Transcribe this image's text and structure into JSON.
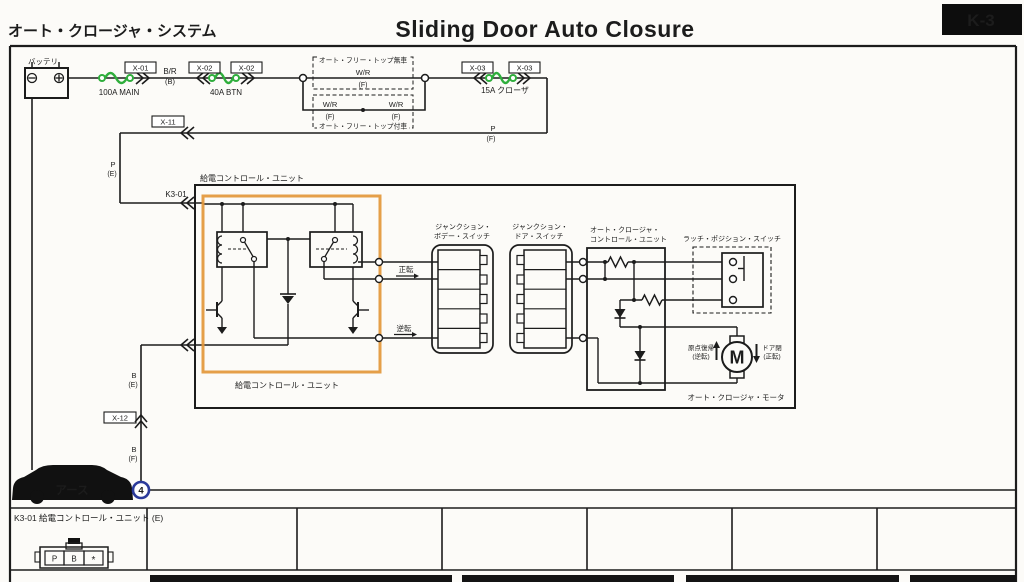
{
  "header": {
    "system_title": "オート・クロージャ・システム",
    "title": "Sliding Door Auto Closure",
    "page_code": "K-3"
  },
  "battery": {
    "label": "バッテリ"
  },
  "fuses": {
    "main": "100A MAIN",
    "btn": "40A BTN",
    "closer": "15A クローザ"
  },
  "connectors": {
    "x01": "X-01",
    "x02": "X-02",
    "x03": "X-03",
    "x11": "X-11",
    "x12": "X-12",
    "k301": "K3-01"
  },
  "wires": {
    "br": "B/R",
    "wr": "W/R",
    "p": "P",
    "b": "B",
    "loc_b": "(B)",
    "loc_e": "(E)",
    "loc_f": "(F)"
  },
  "options": {
    "without_top": "オート・フリー・トップ無車",
    "with_top": "オート・フリー・トップ付車"
  },
  "units": {
    "power": "給電コントロール・ユニット",
    "acu_line1": "オート・クロージャ・",
    "acu_line2": "コントロール・ユニット",
    "jb_body_line1": "ジャンクション・",
    "jb_body_line2": "ボデー・スイッチ",
    "jb_door_line1": "ジャンクション・",
    "jb_door_line2": "ドア・スイッチ",
    "latch": "ラッチ・ポジション・スイッチ",
    "motor": "オート・クロージャ・モータ"
  },
  "signals": {
    "forward": "正転",
    "reverse": "逆転"
  },
  "motor": {
    "m": "M",
    "left_line1": "原点復帰",
    "left_line2": "(逆転)",
    "right_line1": "ドア閉",
    "right_line2": "(正転)"
  },
  "ground": {
    "earth": "アース",
    "point_no": "4"
  },
  "footer": {
    "row1": "K3-01 給電コントロール・ユニット (E)",
    "pin1": "P",
    "pin2": "B",
    "pin3": "*"
  }
}
